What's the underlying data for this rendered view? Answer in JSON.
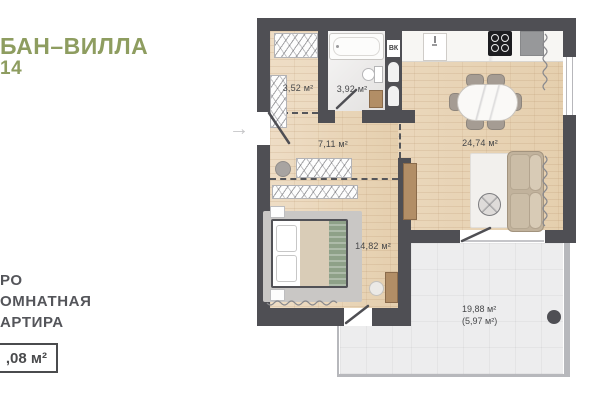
{
  "header": {
    "title_line1": "БАН–ВИЛЛА",
    "title_line2": "14",
    "title_color": "#8e9d60"
  },
  "apartment": {
    "type_line1": "РО",
    "type_line2": "ОМНАТНАЯ",
    "type_line3": "АРТИРА",
    "area_box": ",08 м²"
  },
  "plan": {
    "entry_arrow": "→",
    "vent_label": "ВК",
    "rooms": [
      {
        "name": "dressing-room",
        "area": "3,52 м²"
      },
      {
        "name": "bathroom",
        "area": "3,92 м²"
      },
      {
        "name": "hallway",
        "area": "7,11 м²"
      },
      {
        "name": "kitchen-living-room",
        "area": "24,74 м²"
      },
      {
        "name": "bedroom",
        "area": "14,82 м²"
      },
      {
        "name": "terrace",
        "area": "19,88 м²",
        "area_coefficient": "(5,97 м²)"
      }
    ],
    "colors": {
      "wall": "#4f4f54",
      "accent_green": "#8e9d60",
      "wood_floor": "#ead8bd",
      "bathroom_tile": "#e9e7e6",
      "terrace_tile": "#ededee",
      "label_text": "#47484a"
    }
  }
}
